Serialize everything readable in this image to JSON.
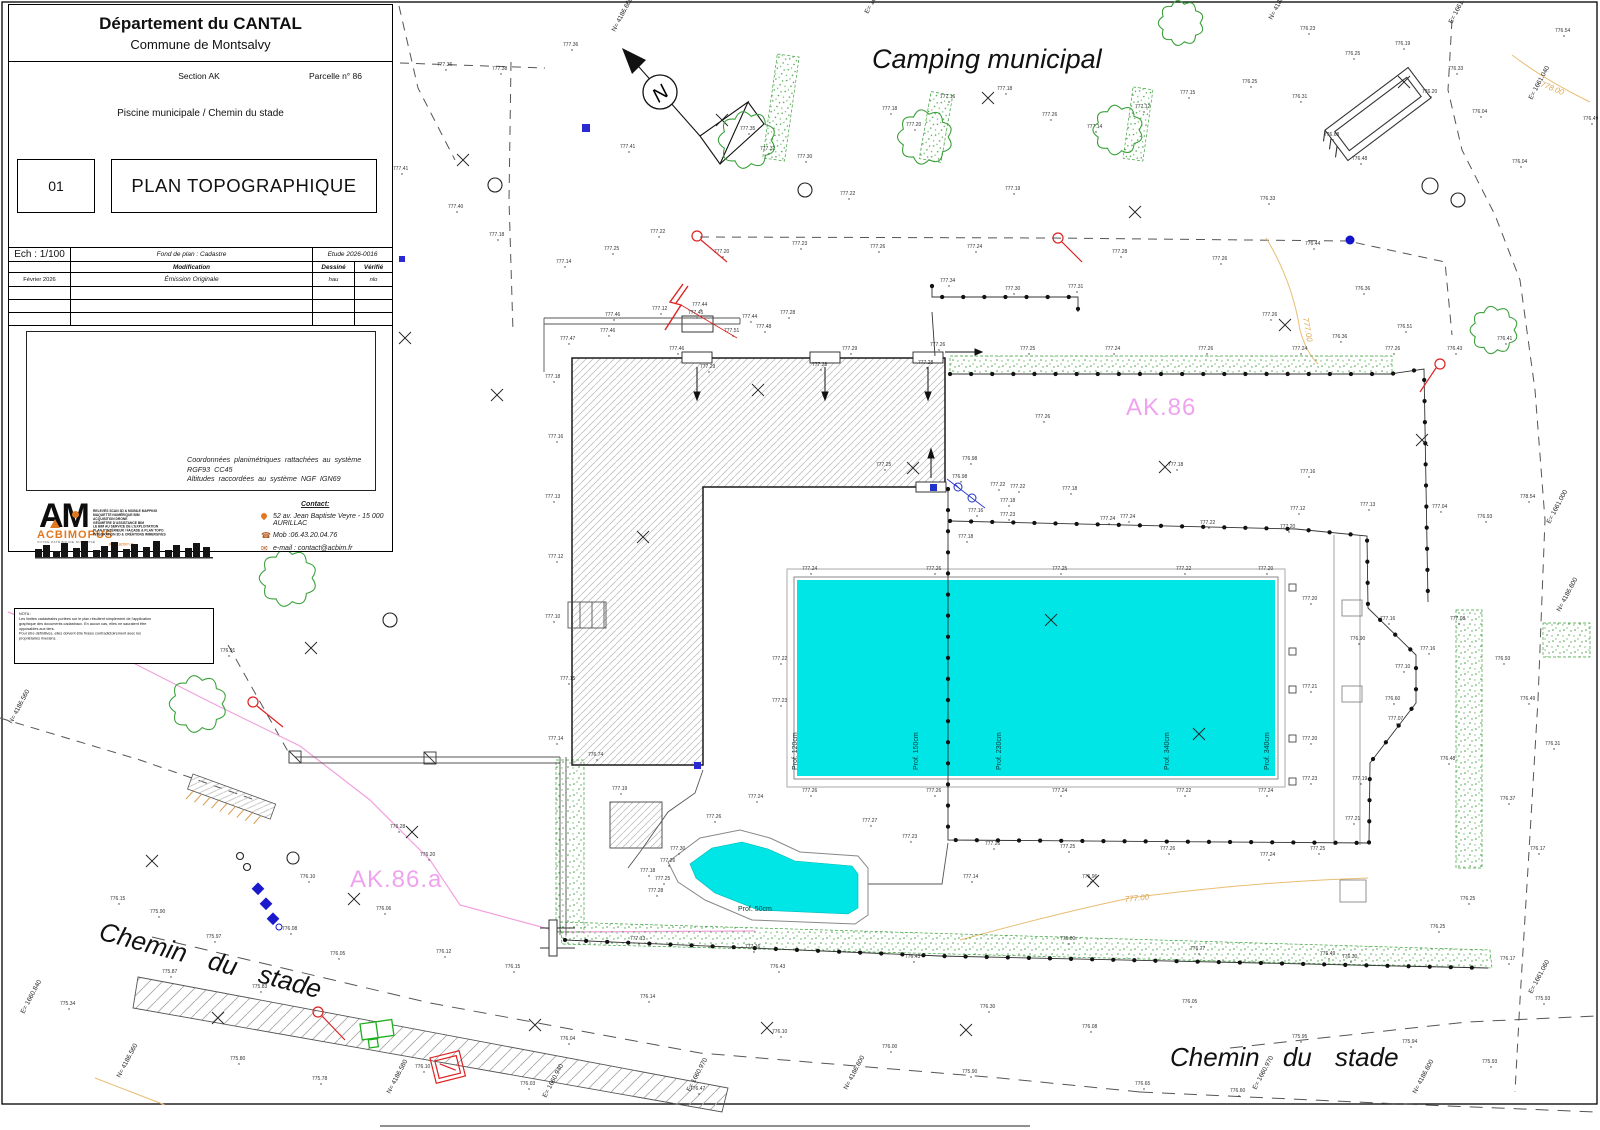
{
  "title_block": {
    "department": "Département du CANTAL",
    "commune": "Commune de Montsalvy",
    "section": "Section AK",
    "parcel": "Parcelle n° 86",
    "subject": "Piscine municipale / Chemin du stade",
    "sheet_number": "01",
    "doc_title": "PLAN TOPOGRAPHIQUE",
    "table": {
      "scale": "Ech : 1/100",
      "basemap": "Fond de plan : Cadastre",
      "study": "Etude 2026-0016",
      "col_modification": "Modification",
      "col_drawn": "Dessiné",
      "col_checked": "Vérifié",
      "rows": [
        {
          "date": "Février 2026",
          "modification": "Émission Originale",
          "drawn": "hau",
          "checked": "nlo"
        }
      ]
    },
    "georef_line1": "Coordonnées planimétriques rattachées au système RGF93 CC45",
    "georef_line2": "Altitudes raccordées au système NGF IGN69",
    "logo": {
      "monogram": "AM",
      "name": "ACBIMOPUS",
      "tagline": "VOTRE PATRIMOINE NUMÉRISÉ",
      "website": "www.acbim.fr",
      "services": [
        "RELEVÉS SCAN 3D & MOBILE MAPPING",
        "MAQUETTE NUMÉRIQUE BIM",
        "ACQUISITION DRONE",
        "GÉOMÈTRE D'ASSISTANCE BIM",
        "LE BIM AU SERVICE DE L'EXPLOITATION",
        "PLAN D'INTÉRIEUR / FAÇADE & PLAN TOPO",
        "INTÉGRATION 3D & CRÉATIONS IMMERSIVES"
      ]
    },
    "contact": {
      "heading": "Contact:",
      "address": "52 av. Jean Baptiste Veyre - 15 000 AURILLAC",
      "mobile": "Mob :06.43.20.04.76",
      "email": "e-mail : contact@acbim.fr"
    }
  },
  "nota": {
    "heading": "NOTA :",
    "lines": [
      "Les limites cadastrales portées sur le plan résultent simplement de l'application",
      "graphique des documents cadastraux. En aucun cas, elles ne sauraient être",
      "opposables aux tiers.",
      "Pour être définitives, elles doivent être fixées contradictoirement avec les",
      "propriétaires riverains."
    ]
  },
  "map": {
    "area_title": "Camping municipal",
    "parcel_label_ak86": "AK.86",
    "parcel_label_ak86a": "AK.86.a",
    "road_label_left": "Chemin du stade",
    "road_label_right": "Chemin du stade",
    "north_letter": "N",
    "pool_depths": [
      "Prof. 120cm",
      "Prof. 150cm",
      "Prof. 230cm",
      "Prof. 340cm",
      "Prof. 340cm"
    ],
    "paddling_depth": "Prof. 50cm",
    "colors": {
      "pool": "#00e6e6",
      "parcel_label": "#efa3ef",
      "vegetation": "#3aa03a",
      "contour": "#dca64f",
      "boundary_pink": "#f2a0dd"
    },
    "contour_labels": [
      {
        "x": 1303,
        "y": 318,
        "r": 80,
        "t": "777.00"
      },
      {
        "x": 1540,
        "y": 86,
        "r": 22,
        "t": "778.00"
      },
      {
        "x": 1125,
        "y": 902,
        "r": -6,
        "t": "777.00"
      }
    ],
    "grid_labels": [
      {
        "x": 615,
        "y": 32,
        "t": "N= 4186.660"
      },
      {
        "x": 868,
        "y": 14,
        "t": "E= 1661.000"
      },
      {
        "x": 1272,
        "y": 20,
        "t": "N= 4186.660"
      },
      {
        "x": 1452,
        "y": 24,
        "t": "E= 1661.020"
      },
      {
        "x": 1532,
        "y": 100,
        "t": "E= 1661.040"
      },
      {
        "x": 1550,
        "y": 524,
        "t": "E= 1661.000"
      },
      {
        "x": 1560,
        "y": 612,
        "t": "N= 4186.600"
      },
      {
        "x": 1532,
        "y": 994,
        "t": "E= 1661.060"
      },
      {
        "x": 12,
        "y": 724,
        "t": "N= 4186.560"
      },
      {
        "x": 24,
        "y": 1014,
        "t": "E= 1660.840"
      },
      {
        "x": 120,
        "y": 1078,
        "t": "N= 4186.560"
      },
      {
        "x": 390,
        "y": 1094,
        "t": "N= 4186.580"
      },
      {
        "x": 546,
        "y": 1098,
        "t": "E= 1660.940"
      },
      {
        "x": 690,
        "y": 1092,
        "t": "E= 1660.970"
      },
      {
        "x": 847,
        "y": 1090,
        "t": "N= 4186.600"
      },
      {
        "x": 1256,
        "y": 1090,
        "t": "E= 1660.970"
      },
      {
        "x": 1416,
        "y": 1094,
        "t": "N= 4186.600"
      }
    ],
    "point_labels": [
      [
        437,
        66,
        "777.36"
      ],
      [
        492,
        70,
        "777.38"
      ],
      [
        563,
        46,
        "777.36"
      ],
      [
        620,
        148,
        "777.41"
      ],
      [
        393,
        170,
        "777.41"
      ],
      [
        448,
        208,
        "777.40"
      ],
      [
        489,
        236,
        "777.18"
      ],
      [
        556,
        263,
        "777.14"
      ],
      [
        604,
        250,
        "777.25"
      ],
      [
        650,
        233,
        "777.22"
      ],
      [
        714,
        253,
        "777.20"
      ],
      [
        760,
        150,
        "777.32"
      ],
      [
        797,
        158,
        "777.30"
      ],
      [
        882,
        110,
        "777.18"
      ],
      [
        906,
        126,
        "777.20"
      ],
      [
        940,
        98,
        "777.16"
      ],
      [
        997,
        90,
        "777.18"
      ],
      [
        1042,
        116,
        "777.26"
      ],
      [
        1087,
        128,
        "777.14"
      ],
      [
        1135,
        108,
        "777.12"
      ],
      [
        1180,
        94,
        "777.15"
      ],
      [
        1242,
        83,
        "776.25"
      ],
      [
        1292,
        98,
        "776.31"
      ],
      [
        1324,
        136,
        "776.68"
      ],
      [
        1352,
        160,
        "776.48"
      ],
      [
        1422,
        93,
        "776.20"
      ],
      [
        1472,
        113,
        "776.04"
      ],
      [
        1512,
        163,
        "776.04"
      ],
      [
        1212,
        260,
        "777.26"
      ],
      [
        1112,
        253,
        "777.28"
      ],
      [
        967,
        248,
        "777.24"
      ],
      [
        870,
        248,
        "777.26"
      ],
      [
        792,
        245,
        "777.23"
      ],
      [
        740,
        130,
        "777.35"
      ],
      [
        840,
        195,
        "777.22"
      ],
      [
        1005,
        190,
        "777.19"
      ],
      [
        1262,
        316,
        "777.26"
      ],
      [
        1332,
        338,
        "776.36"
      ],
      [
        1397,
        328,
        "776.51"
      ],
      [
        1447,
        350,
        "776.43"
      ],
      [
        1497,
        340,
        "776.41"
      ],
      [
        1555,
        32,
        "776.54"
      ],
      [
        1583,
        120,
        "776.49"
      ],
      [
        1300,
        30,
        "776.23"
      ],
      [
        1345,
        55,
        "776.25"
      ],
      [
        1395,
        45,
        "776.19"
      ],
      [
        1448,
        70,
        "776.33"
      ],
      [
        1260,
        200,
        "776.33"
      ],
      [
        1305,
        245,
        "776.44"
      ],
      [
        1355,
        290,
        "776.36"
      ],
      [
        940,
        282,
        "777.34"
      ],
      [
        1005,
        290,
        "777.30"
      ],
      [
        1068,
        288,
        "777.31"
      ],
      [
        605,
        316,
        "777.46"
      ],
      [
        652,
        310,
        "777.12"
      ],
      [
        692,
        306,
        "777.44"
      ],
      [
        742,
        318,
        "777.44"
      ],
      [
        780,
        314,
        "777.28"
      ],
      [
        560,
        340,
        "777.47"
      ],
      [
        600,
        332,
        "777.46"
      ],
      [
        669,
        350,
        "777.46"
      ],
      [
        688,
        314,
        "777.45"
      ],
      [
        724,
        332,
        "777.51"
      ],
      [
        756,
        328,
        "777.48"
      ],
      [
        700,
        368,
        "777.29"
      ],
      [
        812,
        366,
        "777.28"
      ],
      [
        918,
        364,
        "777.28"
      ],
      [
        842,
        350,
        "777.29"
      ],
      [
        930,
        346,
        "777.26"
      ],
      [
        1020,
        350,
        "777.25"
      ],
      [
        1105,
        350,
        "777.24"
      ],
      [
        1198,
        350,
        "777.26"
      ],
      [
        1292,
        350,
        "777.24"
      ],
      [
        1385,
        350,
        "777.26"
      ],
      [
        545,
        378,
        "777.18"
      ],
      [
        548,
        438,
        "777.16"
      ],
      [
        545,
        498,
        "777.13"
      ],
      [
        548,
        558,
        "777.12"
      ],
      [
        545,
        618,
        "777.10"
      ],
      [
        560,
        680,
        "777.15"
      ],
      [
        548,
        740,
        "777.14"
      ],
      [
        1035,
        418,
        "777.26"
      ],
      [
        1168,
        466,
        "777.18"
      ],
      [
        1300,
        473,
        "777.16"
      ],
      [
        962,
        460,
        "776.98"
      ],
      [
        1010,
        488,
        "777.22"
      ],
      [
        1062,
        490,
        "777.18"
      ],
      [
        1120,
        518,
        "777.24"
      ],
      [
        958,
        538,
        "777.18"
      ],
      [
        1360,
        506,
        "777.13"
      ],
      [
        1290,
        510,
        "777.12"
      ],
      [
        1432,
        508,
        "777.04"
      ],
      [
        1477,
        518,
        "776.93"
      ],
      [
        1520,
        498,
        "778.54"
      ],
      [
        876,
        466,
        "777.25"
      ],
      [
        952,
        478,
        "776.98"
      ],
      [
        990,
        486,
        "777.22"
      ],
      [
        1000,
        502,
        "777.18"
      ],
      [
        968,
        512,
        "777.16"
      ],
      [
        802,
        570,
        "777.24"
      ],
      [
        926,
        570,
        "777.26"
      ],
      [
        1052,
        570,
        "777.25"
      ],
      [
        1176,
        570,
        "777.22"
      ],
      [
        1258,
        570,
        "777.20"
      ],
      [
        802,
        792,
        "777.26"
      ],
      [
        926,
        792,
        "777.26"
      ],
      [
        1052,
        792,
        "777.24"
      ],
      [
        1176,
        792,
        "777.22"
      ],
      [
        1258,
        792,
        "777.24"
      ],
      [
        772,
        660,
        "777.22"
      ],
      [
        772,
        702,
        "777.23"
      ],
      [
        1302,
        600,
        "777.20"
      ],
      [
        1302,
        688,
        "777.21"
      ],
      [
        1302,
        740,
        "777.20"
      ],
      [
        1302,
        780,
        "777.23"
      ],
      [
        1000,
        516,
        "777.23"
      ],
      [
        1100,
        520,
        "777.24"
      ],
      [
        1200,
        524,
        "777.22"
      ],
      [
        1280,
        528,
        "777.20"
      ],
      [
        1380,
        620,
        "777.16"
      ],
      [
        1395,
        668,
        "777.10"
      ],
      [
        1388,
        720,
        "777.07"
      ],
      [
        1352,
        780,
        "777.19"
      ],
      [
        1345,
        820,
        "777.21"
      ],
      [
        1310,
        850,
        "777.25"
      ],
      [
        1260,
        856,
        "777.24"
      ],
      [
        1160,
        850,
        "777.26"
      ],
      [
        1060,
        848,
        "777.25"
      ],
      [
        985,
        845,
        "777.26"
      ],
      [
        1450,
        620,
        "777.08"
      ],
      [
        1420,
        650,
        "777.16"
      ],
      [
        1495,
        660,
        "776.93"
      ],
      [
        1520,
        700,
        "776.49"
      ],
      [
        1545,
        745,
        "776.31"
      ],
      [
        1500,
        800,
        "776.37"
      ],
      [
        1530,
        850,
        "776.17"
      ],
      [
        1440,
        760,
        "776.48"
      ],
      [
        1385,
        700,
        "776.60"
      ],
      [
        1350,
        640,
        "776.90"
      ],
      [
        1460,
        900,
        "776.25"
      ],
      [
        1500,
        960,
        "776.17"
      ],
      [
        1535,
        1000,
        "775.93"
      ],
      [
        640,
        872,
        "777.18"
      ],
      [
        670,
        850,
        "777.30"
      ],
      [
        706,
        818,
        "777.26"
      ],
      [
        748,
        798,
        "777.24"
      ],
      [
        862,
        822,
        "777.27"
      ],
      [
        902,
        838,
        "777.23"
      ],
      [
        963,
        878,
        "777.14"
      ],
      [
        1082,
        878,
        "776.96"
      ],
      [
        612,
        790,
        "777.19"
      ],
      [
        588,
        756,
        "776.74"
      ],
      [
        660,
        862,
        "777.26"
      ],
      [
        655,
        880,
        "777.25"
      ],
      [
        648,
        892,
        "777.28"
      ],
      [
        630,
        940,
        "777.13"
      ],
      [
        745,
        948,
        "777.16"
      ],
      [
        905,
        958,
        "776.43"
      ],
      [
        1060,
        940,
        "776.80"
      ],
      [
        1190,
        950,
        "776.77"
      ],
      [
        1320,
        955,
        "776.49"
      ],
      [
        390,
        828,
        "776.28"
      ],
      [
        420,
        856,
        "776.20"
      ],
      [
        300,
        878,
        "776.10"
      ],
      [
        376,
        910,
        "776.06"
      ],
      [
        150,
        913,
        "775.90"
      ],
      [
        206,
        938,
        "775.97"
      ],
      [
        252,
        988,
        "775.83"
      ],
      [
        162,
        973,
        "775.87"
      ],
      [
        436,
        953,
        "776.12"
      ],
      [
        505,
        968,
        "776.15"
      ],
      [
        330,
        955,
        "776.05"
      ],
      [
        282,
        930,
        "776.08"
      ],
      [
        110,
        900,
        "776.15"
      ],
      [
        60,
        1005,
        "775.34"
      ],
      [
        230,
        1060,
        "775.80"
      ],
      [
        312,
        1080,
        "775.78"
      ],
      [
        415,
        1068,
        "776.10"
      ],
      [
        520,
        1085,
        "776.03"
      ],
      [
        220,
        652,
        "776.91"
      ],
      [
        640,
        998,
        "776.14"
      ],
      [
        772,
        1033,
        "776.10"
      ],
      [
        882,
        1048,
        "776.00"
      ],
      [
        962,
        1073,
        "775.90"
      ],
      [
        1082,
        1028,
        "776.08"
      ],
      [
        1182,
        1003,
        "776.05"
      ],
      [
        1292,
        1038,
        "775.95"
      ],
      [
        1402,
        1043,
        "775.94"
      ],
      [
        1482,
        1063,
        "775.93"
      ],
      [
        1342,
        958,
        "776.30"
      ],
      [
        1430,
        928,
        "776.25"
      ],
      [
        770,
        968,
        "776.43"
      ],
      [
        980,
        1008,
        "776.30"
      ],
      [
        1135,
        1085,
        "776.65"
      ],
      [
        1230,
        1092,
        "776.60"
      ],
      [
        690,
        1090,
        "776.47"
      ],
      [
        560,
        1040,
        "776.04"
      ]
    ]
  }
}
